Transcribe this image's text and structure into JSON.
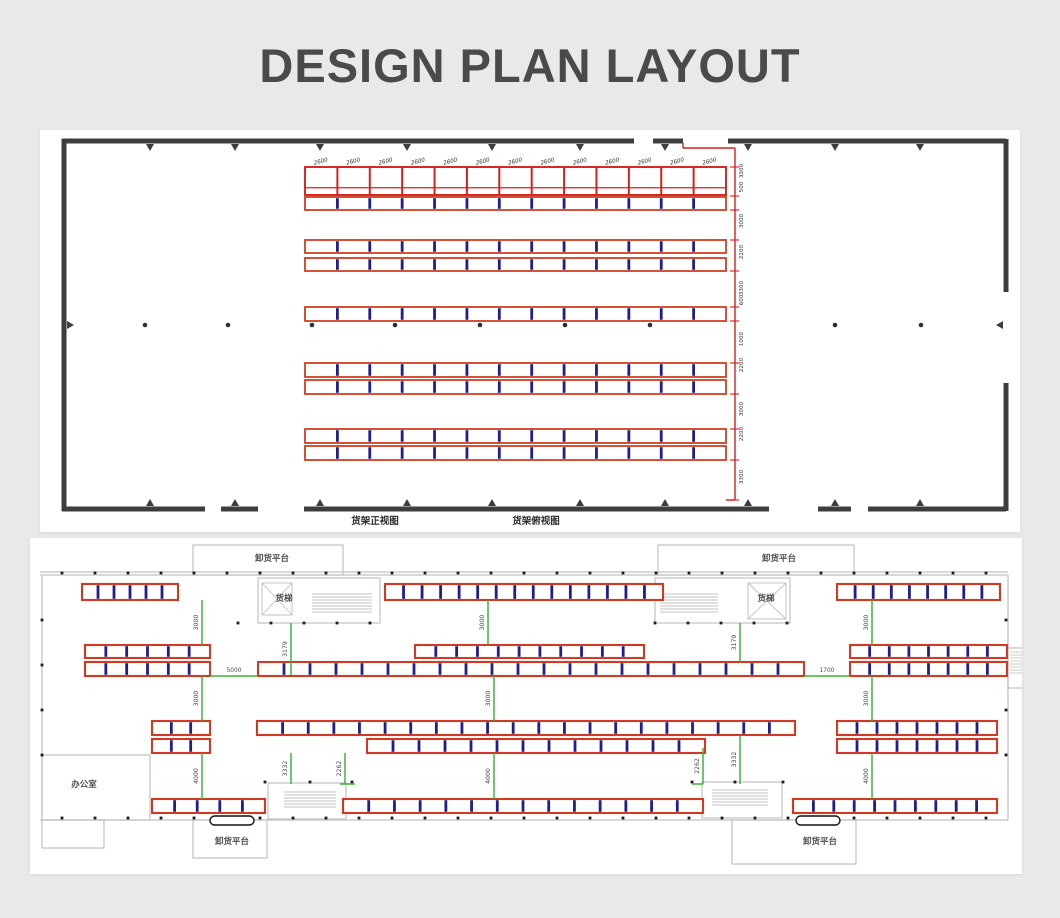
{
  "header": {
    "title": "DESIGN PLAN LAYOUT"
  },
  "colors": {
    "page_bg": "#e9e9e9",
    "panel_bg": "#ffffff",
    "title": "#4a4a4a",
    "wall_dark": "#3d3d3d",
    "rack_red": "#d62019",
    "rack_orange_red": "#d24a2b",
    "floor_rack_red": "#cf3a22",
    "rack_blue": "#1e1e8f",
    "plan_gray": "#c2c2c2",
    "dim_green": "#3db33d",
    "dim_text": "#4a4a4a",
    "dot_black": "#1c1c1c"
  },
  "top_view": {
    "bay_label": "2600",
    "bay_count": 13,
    "walls_h": [
      [
        62,
        141,
        634
      ],
      [
        653,
        141,
        683
      ],
      [
        728,
        141,
        1006
      ],
      [
        62,
        509,
        205
      ],
      [
        221,
        509,
        258
      ],
      [
        304,
        509,
        769
      ],
      [
        818,
        509,
        851
      ],
      [
        868,
        509,
        1006
      ]
    ],
    "walls_v": [
      [
        64,
        139,
        511
      ],
      [
        1006,
        139,
        292
      ],
      [
        1006,
        383,
        511
      ]
    ],
    "ticks_top_x": [
      150,
      235,
      320,
      407,
      492,
      580,
      665,
      748,
      835,
      920
    ],
    "ticks_bottom_x": [
      150,
      235,
      320,
      407,
      492,
      580,
      665,
      748,
      835,
      920
    ],
    "mid_dots": {
      "y": 325,
      "xs": [
        145,
        228,
        312,
        395,
        480,
        565,
        650,
        835,
        921
      ]
    },
    "racks": [
      {
        "x": 305,
        "y": 167,
        "w": 421,
        "h": 28,
        "bays": 13,
        "div": "red",
        "beam": true,
        "stroke": "#d62019",
        "labels": true
      },
      {
        "x": 305,
        "y": 197,
        "w": 421,
        "h": 13,
        "bays": 13,
        "div": "blue"
      },
      {
        "x": 305,
        "y": 240,
        "w": 421,
        "h": 13,
        "bays": 13,
        "div": "blue"
      },
      {
        "x": 305,
        "y": 258,
        "w": 421,
        "h": 13,
        "bays": 13,
        "div": "blue"
      },
      {
        "x": 305,
        "y": 307,
        "w": 421,
        "h": 14,
        "bays": 13,
        "div": "blue"
      },
      {
        "x": 305,
        "y": 363,
        "w": 421,
        "h": 14,
        "bays": 13,
        "div": "blue"
      },
      {
        "x": 305,
        "y": 380,
        "w": 421,
        "h": 14,
        "bays": 13,
        "div": "blue"
      },
      {
        "x": 305,
        "y": 429,
        "w": 421,
        "h": 14,
        "bays": 13,
        "div": "blue"
      },
      {
        "x": 305,
        "y": 446,
        "w": 421,
        "h": 14,
        "bays": 13,
        "div": "blue"
      }
    ],
    "dim_chain": {
      "x": 735,
      "y1": 148,
      "y2": 500,
      "connector": [
        683,
        143,
        683,
        148,
        735,
        148
      ],
      "tick_ys": [
        167,
        196,
        210,
        240,
        271,
        307,
        321,
        363,
        394,
        429,
        460,
        500
      ],
      "labels": [
        {
          "v": "3300",
          "y": 171
        },
        {
          "v": "500",
          "y": 187
        },
        {
          "v": "3000",
          "y": 221
        },
        {
          "v": "2200",
          "y": 252
        },
        {
          "v": "3300",
          "y": 288
        },
        {
          "v": "600",
          "y": 300
        },
        {
          "v": "1000",
          "y": 339
        },
        {
          "v": "2200",
          "y": 365
        },
        {
          "v": "3000",
          "y": 409
        },
        {
          "v": "2200",
          "y": 434
        },
        {
          "v": "3300",
          "y": 477
        }
      ]
    },
    "bottom_labels": [
      {
        "t": "货架正视图",
        "x": 375,
        "y": 524
      },
      {
        "t": "货架俯视图",
        "x": 536,
        "y": 524
      }
    ]
  },
  "floor_plan": {
    "gray_rects": [
      [
        193,
        545,
        150,
        30
      ],
      [
        658,
        545,
        196,
        30
      ],
      [
        258,
        578,
        122,
        45
      ],
      [
        655,
        578,
        135,
        45
      ],
      [
        42,
        755,
        108,
        65
      ],
      [
        42,
        820,
        62,
        28
      ],
      [
        268,
        783,
        78,
        36
      ],
      [
        702,
        782,
        80,
        36
      ],
      [
        193,
        820,
        74,
        38
      ],
      [
        732,
        820,
        124,
        44
      ],
      [
        1008,
        648,
        16,
        40
      ]
    ],
    "gray_lines": [
      [
        40,
        575,
        1008,
        575
      ],
      [
        40,
        572,
        1008,
        572
      ],
      [
        40,
        820,
        1008,
        820
      ],
      [
        42,
        575,
        42,
        820
      ],
      [
        1008,
        575,
        1008,
        820
      ]
    ],
    "ladders": [
      {
        "x": 312,
        "y": 594,
        "w": 60,
        "rows": 7
      },
      {
        "x": 660,
        "y": 594,
        "w": 58,
        "rows": 7
      },
      {
        "x": 284,
        "y": 792,
        "w": 52,
        "rows": 6
      },
      {
        "x": 712,
        "y": 790,
        "w": 56,
        "rows": 6
      },
      {
        "x": 1010,
        "y": 652,
        "w": 12,
        "rows": 8
      }
    ],
    "xboxes": [
      {
        "x": 262,
        "y": 583,
        "w": 30,
        "h": 32
      },
      {
        "x": 748,
        "y": 583,
        "w": 38,
        "h": 36
      }
    ],
    "dot_rows": [
      {
        "y": 573,
        "from": 62,
        "to": 990,
        "step": 33
      },
      {
        "y": 818,
        "from": 62,
        "to": 990,
        "step": 33
      }
    ],
    "dot_cols": [
      {
        "x": 42,
        "ys": [
          620,
          665,
          710,
          755
        ]
      },
      {
        "x": 1006,
        "ys": [
          620,
          665,
          710,
          755
        ]
      }
    ],
    "dot_extra": [
      {
        "y": 623,
        "xs": [
          238,
          271,
          304,
          337,
          370,
          655,
          688,
          721,
          754,
          787
        ]
      },
      {
        "y": 782,
        "xs": [
          265,
          310,
          352,
          692,
          735,
          783
        ]
      }
    ],
    "racks": [
      {
        "x": 82,
        "y": 584,
        "w": 96,
        "h": 16,
        "bays": 6
      },
      {
        "x": 385,
        "y": 584,
        "w": 278,
        "h": 16,
        "bays": 15
      },
      {
        "x": 837,
        "y": 584,
        "w": 163,
        "h": 16,
        "bays": 9
      },
      {
        "x": 85,
        "y": 645,
        "w": 125,
        "h": 13,
        "bays": 6
      },
      {
        "x": 415,
        "y": 645,
        "w": 229,
        "h": 13,
        "bays": 11
      },
      {
        "x": 850,
        "y": 645,
        "w": 157,
        "h": 13,
        "bays": 8
      },
      {
        "x": 85,
        "y": 662,
        "w": 125,
        "h": 14,
        "bays": 6
      },
      {
        "x": 258,
        "y": 662,
        "w": 546,
        "h": 14,
        "bays": 21
      },
      {
        "x": 850,
        "y": 662,
        "w": 157,
        "h": 14,
        "bays": 8
      },
      {
        "x": 152,
        "y": 721,
        "w": 58,
        "h": 14,
        "bays": 3
      },
      {
        "x": 257,
        "y": 721,
        "w": 538,
        "h": 14,
        "bays": 21
      },
      {
        "x": 837,
        "y": 721,
        "w": 160,
        "h": 14,
        "bays": 8
      },
      {
        "x": 152,
        "y": 739,
        "w": 58,
        "h": 14,
        "bays": 3
      },
      {
        "x": 367,
        "y": 739,
        "w": 338,
        "h": 14,
        "bays": 13
      },
      {
        "x": 837,
        "y": 739,
        "w": 160,
        "h": 14,
        "bays": 8
      },
      {
        "x": 152,
        "y": 799,
        "w": 113,
        "h": 14,
        "bays": 5
      },
      {
        "x": 343,
        "y": 799,
        "w": 360,
        "h": 14,
        "bays": 14
      },
      {
        "x": 793,
        "y": 799,
        "w": 204,
        "h": 14,
        "bays": 10
      }
    ],
    "v_dims": [
      {
        "v": "3000",
        "x": 202,
        "y1": 600,
        "y2": 645
      },
      {
        "v": "3000",
        "x": 488,
        "y1": 600,
        "y2": 645
      },
      {
        "v": "3000",
        "x": 872,
        "y1": 600,
        "y2": 645
      },
      {
        "v": "3179",
        "x": 291,
        "y1": 623,
        "y2": 675
      },
      {
        "v": "3179",
        "x": 740,
        "y1": 623,
        "y2": 662
      },
      {
        "v": "3000",
        "x": 202,
        "y1": 676,
        "y2": 721
      },
      {
        "v": "3000",
        "x": 494,
        "y1": 676,
        "y2": 721
      },
      {
        "v": "3000",
        "x": 872,
        "y1": 676,
        "y2": 721
      },
      {
        "v": "4000",
        "x": 202,
        "y1": 753,
        "y2": 799
      },
      {
        "v": "4000",
        "x": 494,
        "y1": 753,
        "y2": 799
      },
      {
        "v": "4000",
        "x": 872,
        "y1": 753,
        "y2": 799
      },
      {
        "v": "3332",
        "x": 291,
        "y1": 753,
        "y2": 784
      },
      {
        "v": "2262",
        "x": 345,
        "y1": 753,
        "y2": 784
      },
      {
        "v": "3332",
        "x": 740,
        "y1": 735,
        "y2": 784
      },
      {
        "v": "2262",
        "x": 703,
        "y1": 748,
        "y2": 784
      }
    ],
    "h_dims": [
      {
        "v": "5000",
        "x1": 210,
        "x2": 258,
        "y": 676
      },
      {
        "v": "1700",
        "x1": 804,
        "x2": 850,
        "y": 676
      }
    ],
    "green_jogs": [
      [
        340,
        784,
        355,
        784
      ],
      [
        692,
        784,
        703,
        784
      ]
    ],
    "pills": [
      [
        210,
        816,
        44,
        9
      ],
      [
        796,
        816,
        44,
        9
      ]
    ],
    "labels": [
      {
        "t": "卸货平台",
        "x": 272,
        "y": 561
      },
      {
        "t": "卸货平台",
        "x": 779,
        "y": 561
      },
      {
        "t": "货梯",
        "x": 284,
        "y": 601
      },
      {
        "t": "货梯",
        "x": 766,
        "y": 601
      },
      {
        "t": "办公室",
        "x": 84,
        "y": 787
      },
      {
        "t": "卸货平台",
        "x": 232,
        "y": 844
      },
      {
        "t": "卸货平台",
        "x": 820,
        "y": 844
      }
    ]
  }
}
